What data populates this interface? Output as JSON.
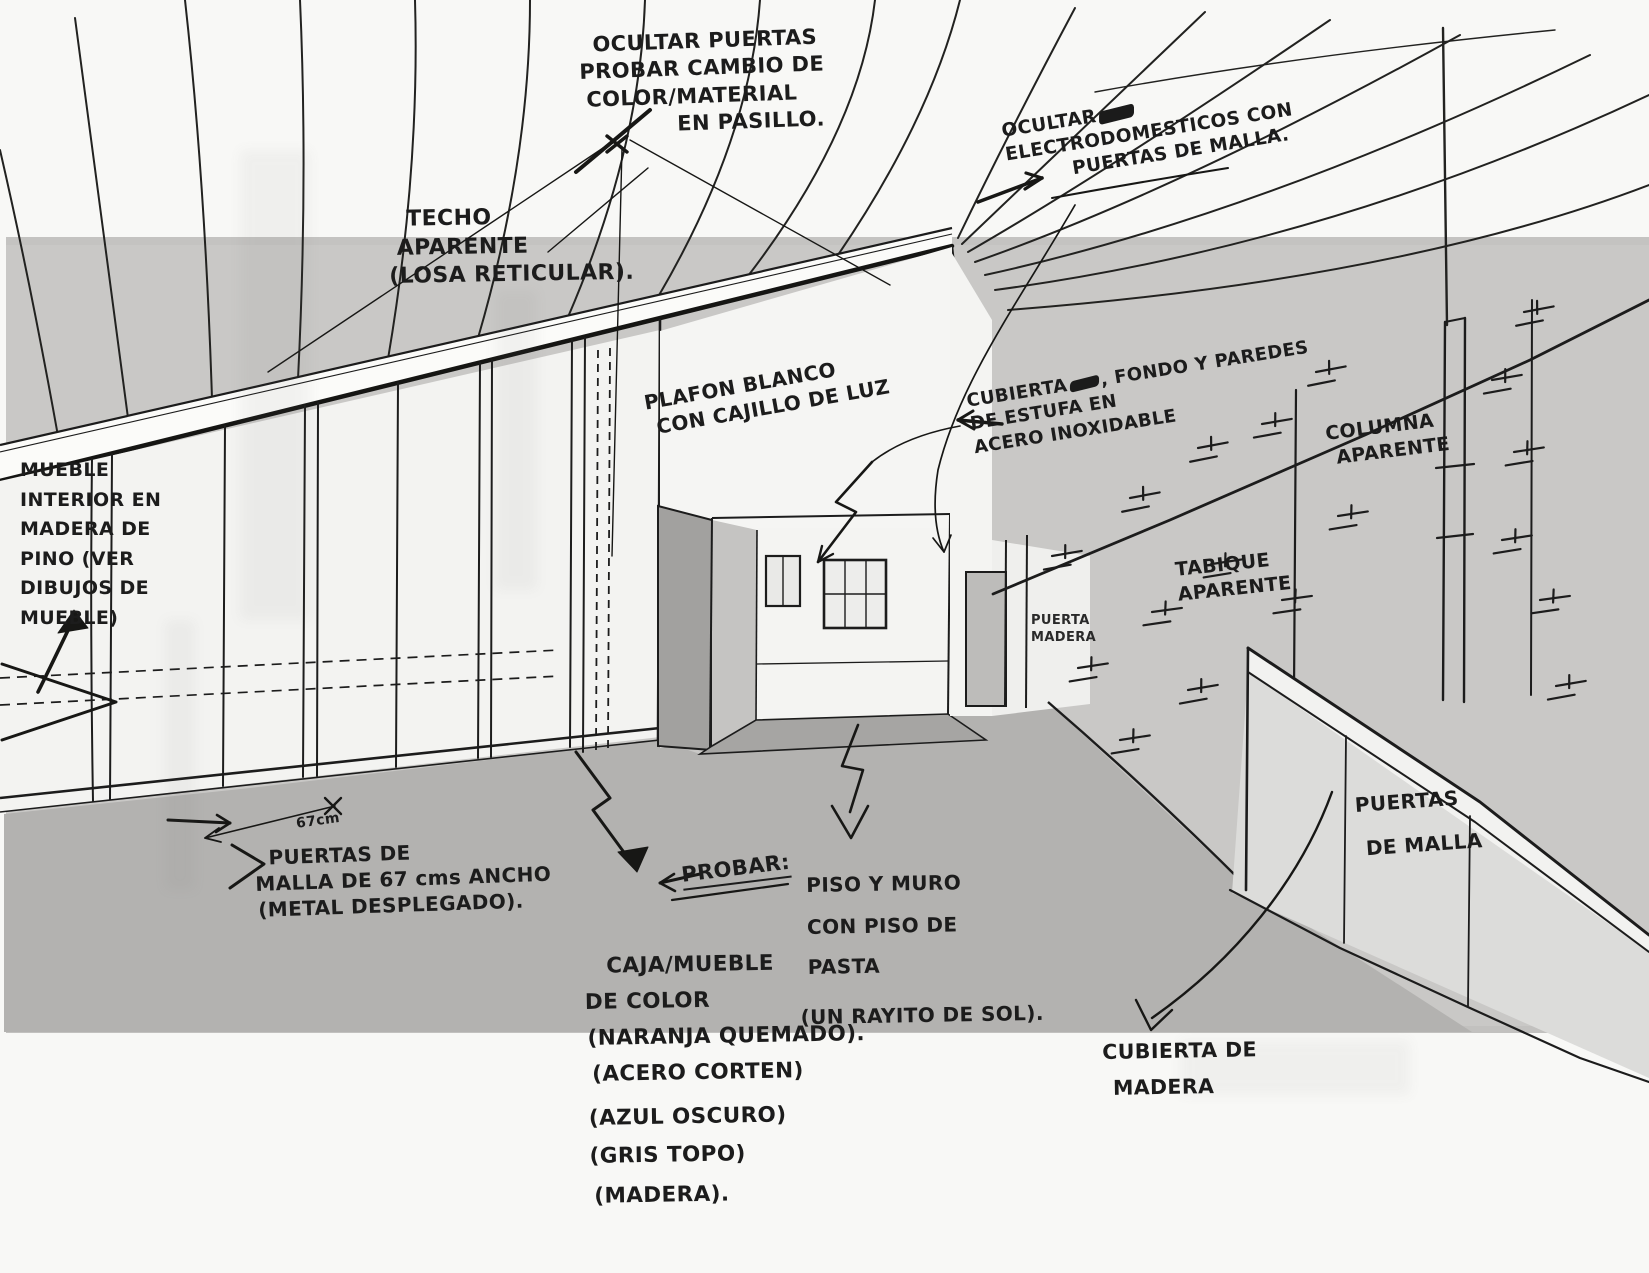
{
  "colors": {
    "paper": "#f8f8f6",
    "gray_band": "#c9c8c6",
    "floor_gray": "#b3b2b0",
    "ink": "#1c1c1c"
  },
  "annotations": {
    "ocultar_puertas": {
      "l1": "OCULTAR PUERTAS",
      "l2": "PROBAR CAMBIO DE",
      "l3": "COLOR/MATERIAL",
      "l4": "EN PASILLO."
    },
    "ocultar_electro": {
      "l1": "OCULTAR",
      "l2": "ELECTRODOMESTICOS CON",
      "l3": "PUERTAS DE MALLA."
    },
    "techo": {
      "l1": "TECHO",
      "l2": "APARENTE",
      "l3": "(LOSA RETICULAR)."
    },
    "plafon": {
      "l1": "PLAFON BLANCO",
      "l2": "CON CAJILLO DE LUZ"
    },
    "cubierta_estufa": {
      "l1a": "CUBIERTA",
      "l1b": ", FONDO Y PAREDES",
      "l2": "DE ESTUFA EN",
      "l3": "ACERO INOXIDABLE"
    },
    "columna": {
      "l1": "COLUMNA",
      "l2": "APARENTE"
    },
    "tabique": {
      "l1": "TABIQUE",
      "l2": "APARENTE"
    },
    "mueble_interior": {
      "l1": "MUEBLE",
      "l2": "INTERIOR EN",
      "l3": "MADERA DE",
      "l4": "PINO (VER",
      "l5": "DIBUJOS DE",
      "l6": "MUEBLE)"
    },
    "dim_67": "67cm",
    "puertas_malla_izq": {
      "l1": "PUERTAS DE",
      "l2": "MALLA DE 67 cms ANCHO",
      "l3": "(METAL DESPLEGADO)."
    },
    "probar": "PROBAR:",
    "caja_mueble": {
      "l1": "CAJA/MUEBLE",
      "l2": "DE COLOR",
      "l3": "(NARANJA QUEMADO).",
      "l4": "(ACERO CORTEN)",
      "l5": "(AZUL OSCURO)",
      "l6": "(GRIS TOPO)",
      "l7": "(MADERA)."
    },
    "piso_muro": {
      "l1": "PISO Y MURO",
      "l2": "CON PISO DE",
      "l3": "PASTA",
      "l4": "(UN RAYITO DE SOL)."
    },
    "puertas_malla_der": {
      "l1": "PUERTAS",
      "l2": "DE MALLA"
    },
    "cubierta_madera": {
      "l1": "CUBIERTA DE",
      "l2": "MADERA"
    },
    "puerta_madera": {
      "l1": "PUERTA",
      "l2": "MADERA"
    }
  }
}
